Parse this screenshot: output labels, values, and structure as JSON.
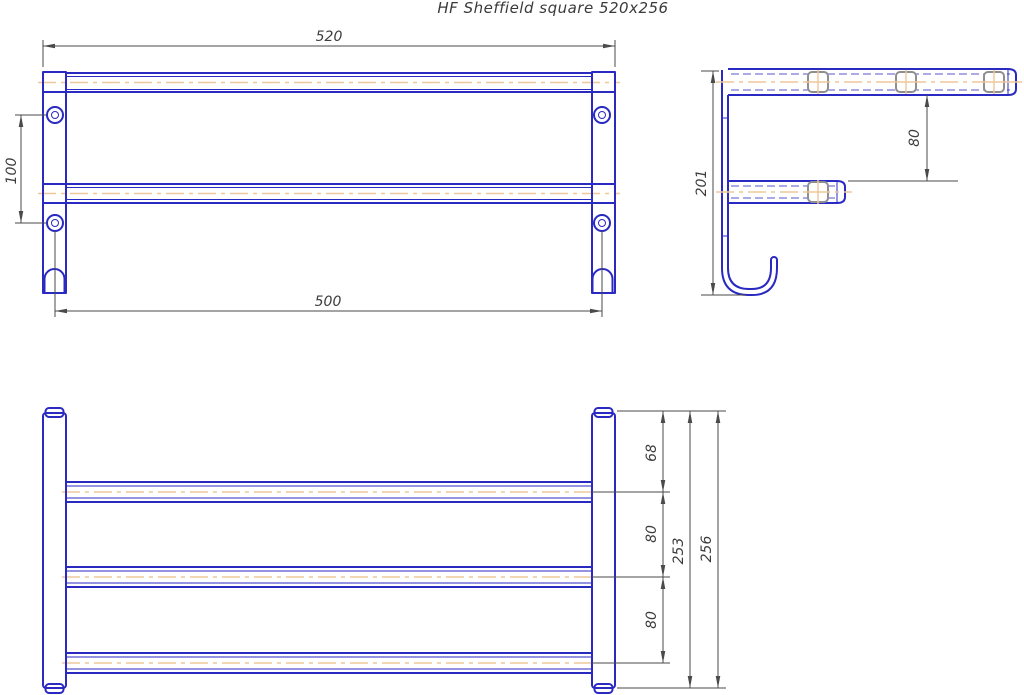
{
  "title": "HF Sheffield square 520x256",
  "colors": {
    "outline_blue": "#2a2ac2",
    "centerline_orange": "#eec89a",
    "dimension_gray": "#4a4a4a",
    "clip_gray": "#8f8f8f",
    "background": "#ffffff"
  },
  "views": {
    "plan": {
      "name": "plan view (top rack with mounting posts)",
      "dims": {
        "overall_width": "520",
        "hole_spacing": "100",
        "mounting_span": "500"
      }
    },
    "side": {
      "name": "side profile (wall bracket with shelf, bar and J-hook)",
      "dims": {
        "overall_height": "201",
        "shelf_to_bar_gap": "80"
      }
    },
    "front": {
      "name": "front view (three towel bars between posts)",
      "dims": {
        "top_to_first_bar": "68",
        "first_to_second_bar": "80",
        "second_to_third_bar": "80",
        "bars_span": "253",
        "overall_height": "256"
      }
    }
  }
}
